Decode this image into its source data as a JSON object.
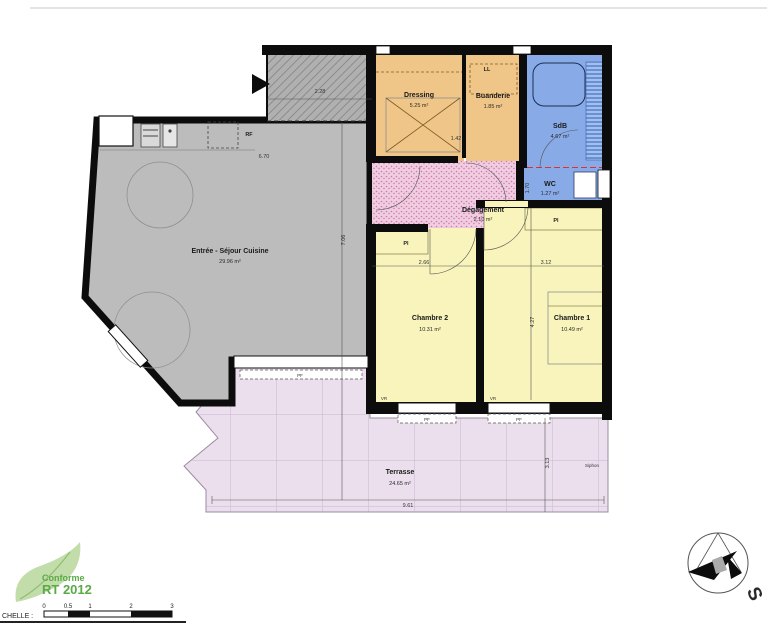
{
  "plan": {
    "rooms": [
      {
        "id": "sejour",
        "label": "Entrée - Séjour Cuisine",
        "area": "29.96 m²",
        "color": "#bcbcbc"
      },
      {
        "id": "dressing",
        "label": "Dressing",
        "area": "5.25 m²",
        "color": "#f0c688"
      },
      {
        "id": "buanderie",
        "label": "Buanderie",
        "area": "1.85 m²",
        "color": "#f0c688"
      },
      {
        "id": "sdb",
        "label": "SdB",
        "area": "4.67 m²",
        "color": "#88abe8"
      },
      {
        "id": "wc",
        "label": "WC",
        "area": "1.27 m²",
        "color": "#88abe8"
      },
      {
        "id": "degagement",
        "label": "Dégagement",
        "area": "2.10 m²",
        "color": "#f0cde0"
      },
      {
        "id": "chambre2",
        "label": "Chambre 2",
        "area": "10.31 m²",
        "color": "#f8f4bc"
      },
      {
        "id": "chambre1",
        "label": "Chambre 1",
        "area": "10.49 m²",
        "color": "#f8f4bc"
      },
      {
        "id": "terrasse",
        "label": "Terrasse",
        "area": "24.65 m²",
        "color": "#ebdfed"
      }
    ],
    "fixture_labels": {
      "rf": "RF",
      "ll": "LL",
      "pl": "Pl",
      "pf": "PF",
      "vr": "VR"
    },
    "dimensions": [
      "2.28",
      "6.70",
      "7.06",
      "1.42",
      "1.70",
      "2.66",
      "3.12",
      "4.27",
      "9.61",
      "3.13"
    ],
    "annotations": {
      "siphon": "Siphon"
    }
  },
  "rt2012": {
    "line1": "Conforme",
    "line2": "RT 2012",
    "color": "#5aaa46",
    "leaf_color": "#b7d79b"
  },
  "scalebar": {
    "label": "CHELLE :",
    "ticks": [
      "0",
      "0.5",
      "1",
      "2",
      "3"
    ]
  },
  "compass": {
    "south": "S"
  }
}
